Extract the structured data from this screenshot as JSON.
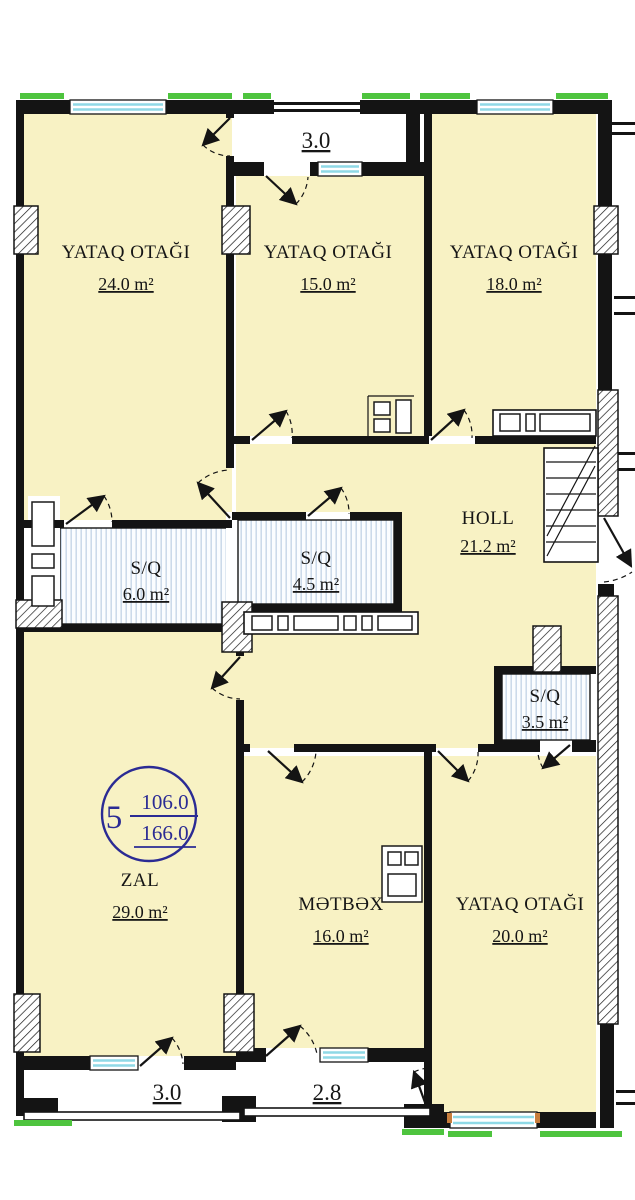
{
  "plan": {
    "title": "apartment-floor-plan",
    "unit_badge": {
      "number": "5",
      "area_upper": "106.0",
      "area_lower": "166.0"
    },
    "area_unit": "m²",
    "rooms": [
      {
        "id": "bedroom-1",
        "name": "YATAQ OTAĞI",
        "area": "24.0 m²"
      },
      {
        "id": "bedroom-2",
        "name": "YATAQ OTAĞI",
        "area": "15.0 m²"
      },
      {
        "id": "bedroom-3",
        "name": "YATAQ OTAĞI",
        "area": "18.0 m²"
      },
      {
        "id": "hall",
        "name": "HOLL",
        "area": "21.2 m²"
      },
      {
        "id": "bathroom-1",
        "name": "S/Q",
        "area": "6.0 m²"
      },
      {
        "id": "bathroom-2",
        "name": "S/Q",
        "area": "4.5 m²"
      },
      {
        "id": "bathroom-3",
        "name": "S/Q",
        "area": "3.5 m²"
      },
      {
        "id": "living-room",
        "name": "ZAL",
        "area": "29.0 m²"
      },
      {
        "id": "kitchen",
        "name": "MƏTBƏX",
        "area": "16.0 m²"
      },
      {
        "id": "bedroom-4",
        "name": "YATAQ OTAĞI",
        "area": "20.0 m²"
      }
    ],
    "balconies": [
      {
        "id": "balcony-top",
        "value": "3.0"
      },
      {
        "id": "balcony-bottom-left",
        "value": "3.0"
      },
      {
        "id": "balcony-bottom-center",
        "value": "2.8"
      }
    ],
    "colors": {
      "room_fill": "#f8f2c4",
      "wet_room_stripe": "#c9d9e9",
      "window_glass": "#8fd9e6",
      "facade_accent": "#4ec43e",
      "badge_ink": "#2b2b94",
      "line_ink": "#141414"
    }
  }
}
